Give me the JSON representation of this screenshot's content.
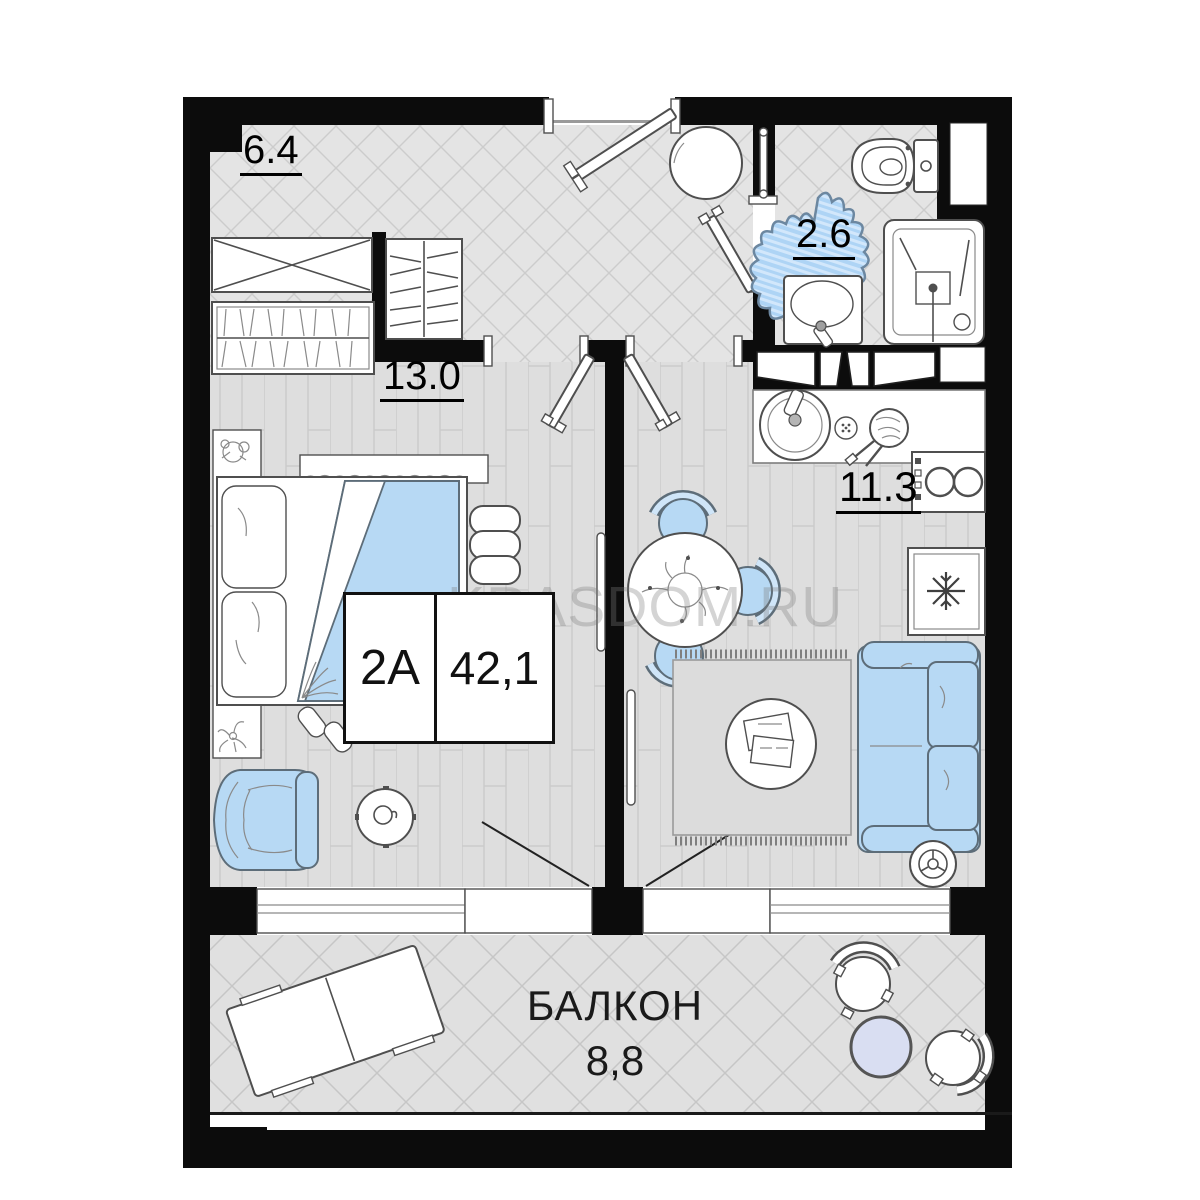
{
  "unit": {
    "type": "2A",
    "area": "42,1"
  },
  "rooms": {
    "hallway_area": "6.4",
    "bedroom_area": "13.0",
    "bathroom_area": "2.6",
    "kitchen_living_area": "11.3"
  },
  "balcony": {
    "name": "БАЛКОН",
    "area": "8,8"
  },
  "watermark": "KRASDOM.RU",
  "colors": {
    "walls": "#0c0c0c",
    "furniture_accent_blue": "#b7d9f4",
    "tile_floor": "#e4e4e4",
    "plank_floor": "#dedede",
    "balcony_table_blue": "#d9def2",
    "outline_gray": "#4f4f4f"
  },
  "icons": [
    "bed-icon",
    "armchair-icon",
    "side-table-icon",
    "wardrobe-icon",
    "shoe-rack-icon",
    "hanger-closet-icon",
    "toilet-icon",
    "sink-icon",
    "shower-icon",
    "bath-rug-icon",
    "towel-rail-icon",
    "kitchen-counter-icon",
    "kitchen-sink-icon",
    "pan-icon",
    "stove-icon",
    "fridge-icon",
    "dining-table-icon",
    "chair-icon",
    "rug-icon",
    "coffee-table-icon",
    "sofa-icon",
    "vacuum-icon",
    "mirror-icon",
    "entry-door-icon",
    "bathroom-door-icon",
    "interior-door-icon",
    "window-icon",
    "lounger-icon",
    "balcony-chair-icon",
    "balcony-table-icon"
  ]
}
